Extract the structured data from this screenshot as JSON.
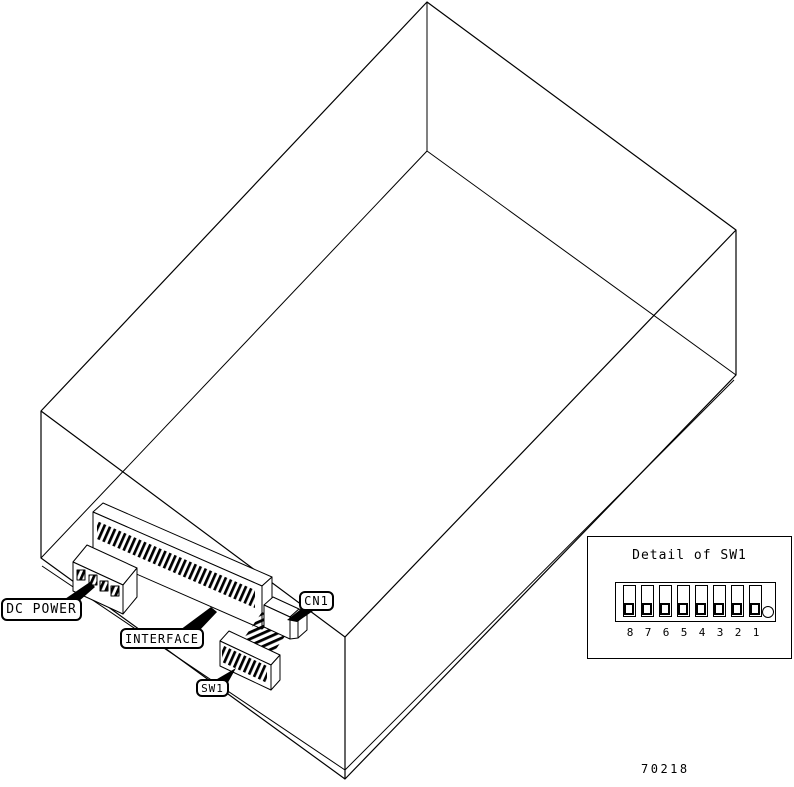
{
  "callouts": {
    "dc_power": {
      "label": "DC POWER"
    },
    "interface": {
      "label": "INTERFACE"
    },
    "cn1": {
      "label": "CN1"
    },
    "sw1": {
      "label": "SW1"
    }
  },
  "detail_panel": {
    "title": "Detail of SW1",
    "switch_positions": [
      "8",
      "7",
      "6",
      "5",
      "4",
      "3",
      "2",
      "1"
    ],
    "switch_state": "down"
  },
  "figure": {
    "number": "70218"
  },
  "colors": {
    "line": "#000000",
    "background": "#ffffff"
  }
}
